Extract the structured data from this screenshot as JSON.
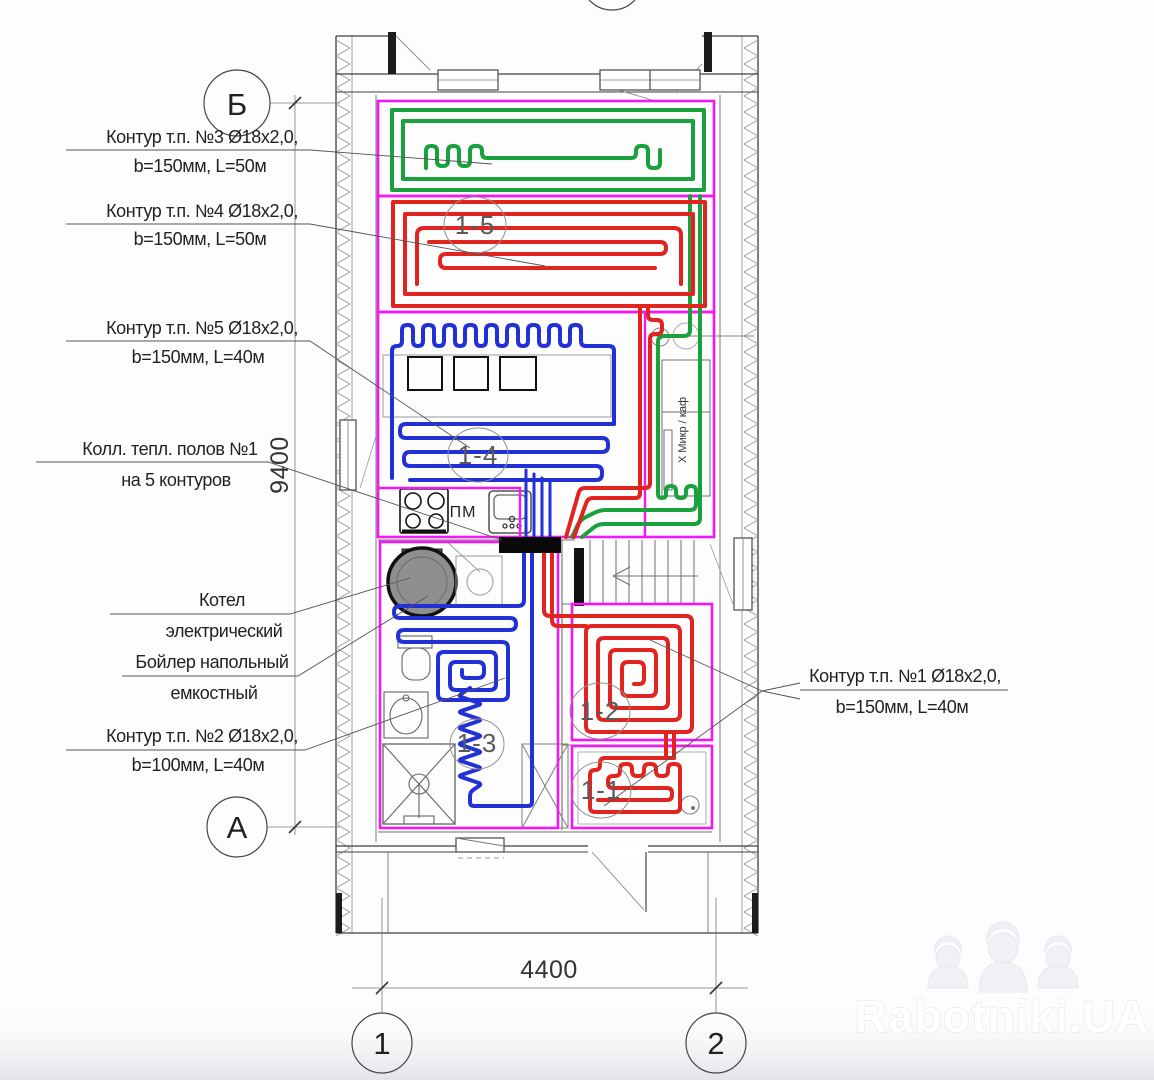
{
  "axes": {
    "top_left": "Б",
    "bottom_left": "А",
    "col1": "1",
    "col2": "2"
  },
  "dims": {
    "height": "9400",
    "width": "4400"
  },
  "callouts": {
    "c3l1": "Контур т.п. №3 Ø18х2,0,",
    "c3l2": "b=150мм, L=50м",
    "c4l1": "Контур т.п. №4 Ø18х2,0,",
    "c4l2": "b=150мм, L=50м",
    "c5l1": "Контур т.п. №5 Ø18х2,0,",
    "c5l2": "b=150мм, L=40м",
    "coll1": "Колл. тепл. полов №1",
    "coll2": "на 5 контуров",
    "kot1": "Котел",
    "kot2": "электрический",
    "tank1": "Бойлер напольный",
    "tank2": "емкостный",
    "c2l1": "Контур т.п. №2 Ø18х2,0,",
    "c2l2": "b=100мм, L=40м",
    "c1l1": "Контур т.п. №1 Ø18х2,0,",
    "c1l2": "b=150мм, L=40м"
  },
  "rooms": {
    "r15": "1-5",
    "r14": "1-4",
    "r12": "1-2",
    "r13": "1-3",
    "r11": "1-1"
  },
  "labels": {
    "pm": "ПМ",
    "shelf": "Х Микр / каф"
  },
  "watermark": {
    "text": "Rabotniki.UA"
  },
  "colors": {
    "green": "#18a13c",
    "red": "#e22420",
    "blue": "#2231d6",
    "magenta": "#f318f3",
    "wall": "#3f3f3f",
    "thin": "#777777",
    "leader": "#555555"
  }
}
